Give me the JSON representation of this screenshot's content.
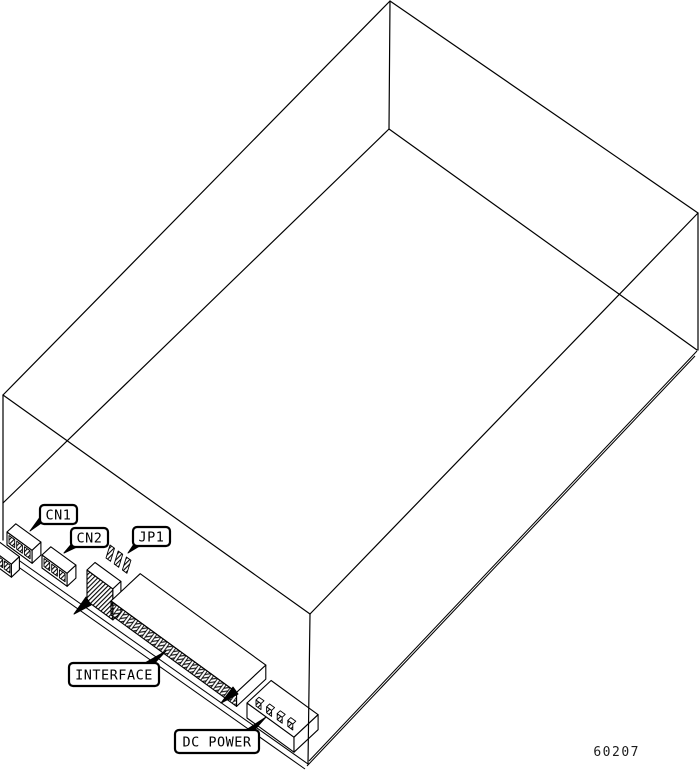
{
  "figure": {
    "kind": "isometric-line-drawing",
    "subject": "disk drive rear connector diagram",
    "part_number": "60207"
  },
  "callouts": [
    {
      "id": "cn1",
      "label": "CN1"
    },
    {
      "id": "cn2",
      "label": "CN2"
    },
    {
      "id": "jp1",
      "label": "JP1"
    },
    {
      "id": "interface",
      "label": "INTERFACE"
    },
    {
      "id": "dc-power",
      "label": "DC POWER"
    }
  ],
  "colors": {
    "line": "#000000",
    "background": "#ffffff",
    "label_fill": "#ffffff",
    "label_border": "#000000"
  }
}
